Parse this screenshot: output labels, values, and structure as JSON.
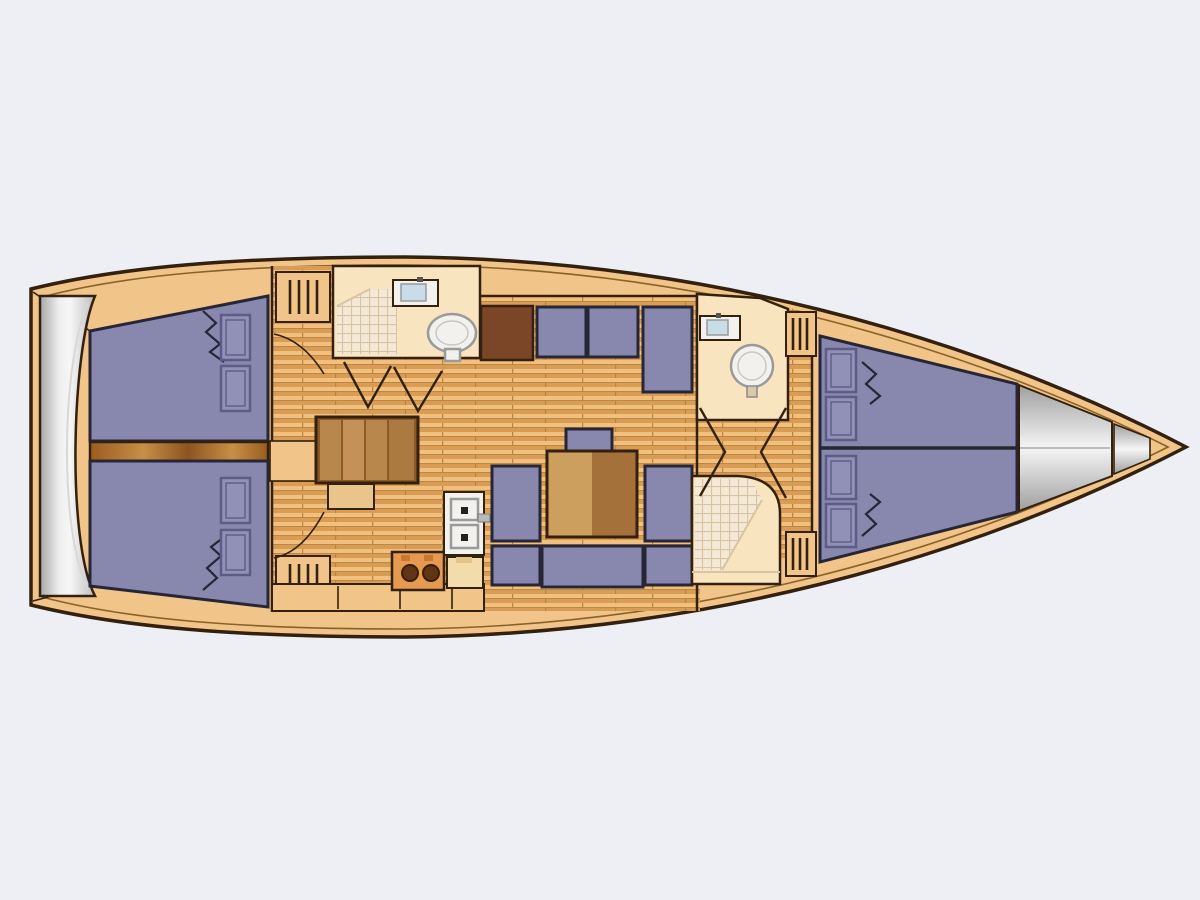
{
  "diagram": {
    "kind": "sailing-yacht-interior-layout-plan",
    "view": "top-down",
    "orientation": "bow-right-stern-left",
    "cabins": 3,
    "heads": 2,
    "rooms": [
      "swim-platform",
      "aft-cabin-port",
      "aft-cabin-starboard",
      "engine-compartment",
      "companionway-steps",
      "aft-head-with-shower",
      "saloon",
      "galley",
      "forward-head",
      "forward-shower",
      "forward-cabin-v-berth",
      "anchor-locker",
      "bow"
    ],
    "furniture": {
      "aft_cabin_berths": 2,
      "pillows_per_aft_berth": 2,
      "saloon_settees": [
        "l-shaped-starboard-settee",
        "u-shaped-port-settee"
      ],
      "saloon_table": "rectangular-two-tone-wood",
      "galley_items": [
        "double-sink",
        "two-burner-stove",
        "cabinets"
      ],
      "head_fixtures": [
        "washbasin",
        "toilet",
        "shower-tiled-area"
      ],
      "v_berth_pillows": 4,
      "hanging_lockers": 4
    }
  },
  "colors": {
    "background": "#edeff4",
    "hull_deck": "#f1c489",
    "outline": "#33200e",
    "inner_line": "#8a6228",
    "plank_light": "#f2c07e",
    "plank_dark": "#d89c55",
    "cushion": "#8888af",
    "cushion_border": "#262637",
    "pillow": "#9191b8",
    "pillow_line": "#5c5c86",
    "head_floor": "#f8e5c0",
    "shower_tile": "#f4e8d6",
    "tile_grid": "#d8c4a2",
    "fixture_white": "#f2f1ee",
    "fixture_shadow": "#9a9a9a",
    "basin_blue": "#c9dde8",
    "cabinet_dark": "#7b4527",
    "wood_table_light": "#cd9f5e",
    "wood_table_dark": "#a5713a",
    "wood_steps": "#b8874c",
    "steps_frame": "#8a5a28",
    "stove_body": "#e59a50",
    "burner": "#613413",
    "engine_dark": "#9a5c20",
    "engine_light": "#c68f45",
    "metal_light": "#f6f6f6",
    "metal_dark": "#a8a8a8"
  }
}
